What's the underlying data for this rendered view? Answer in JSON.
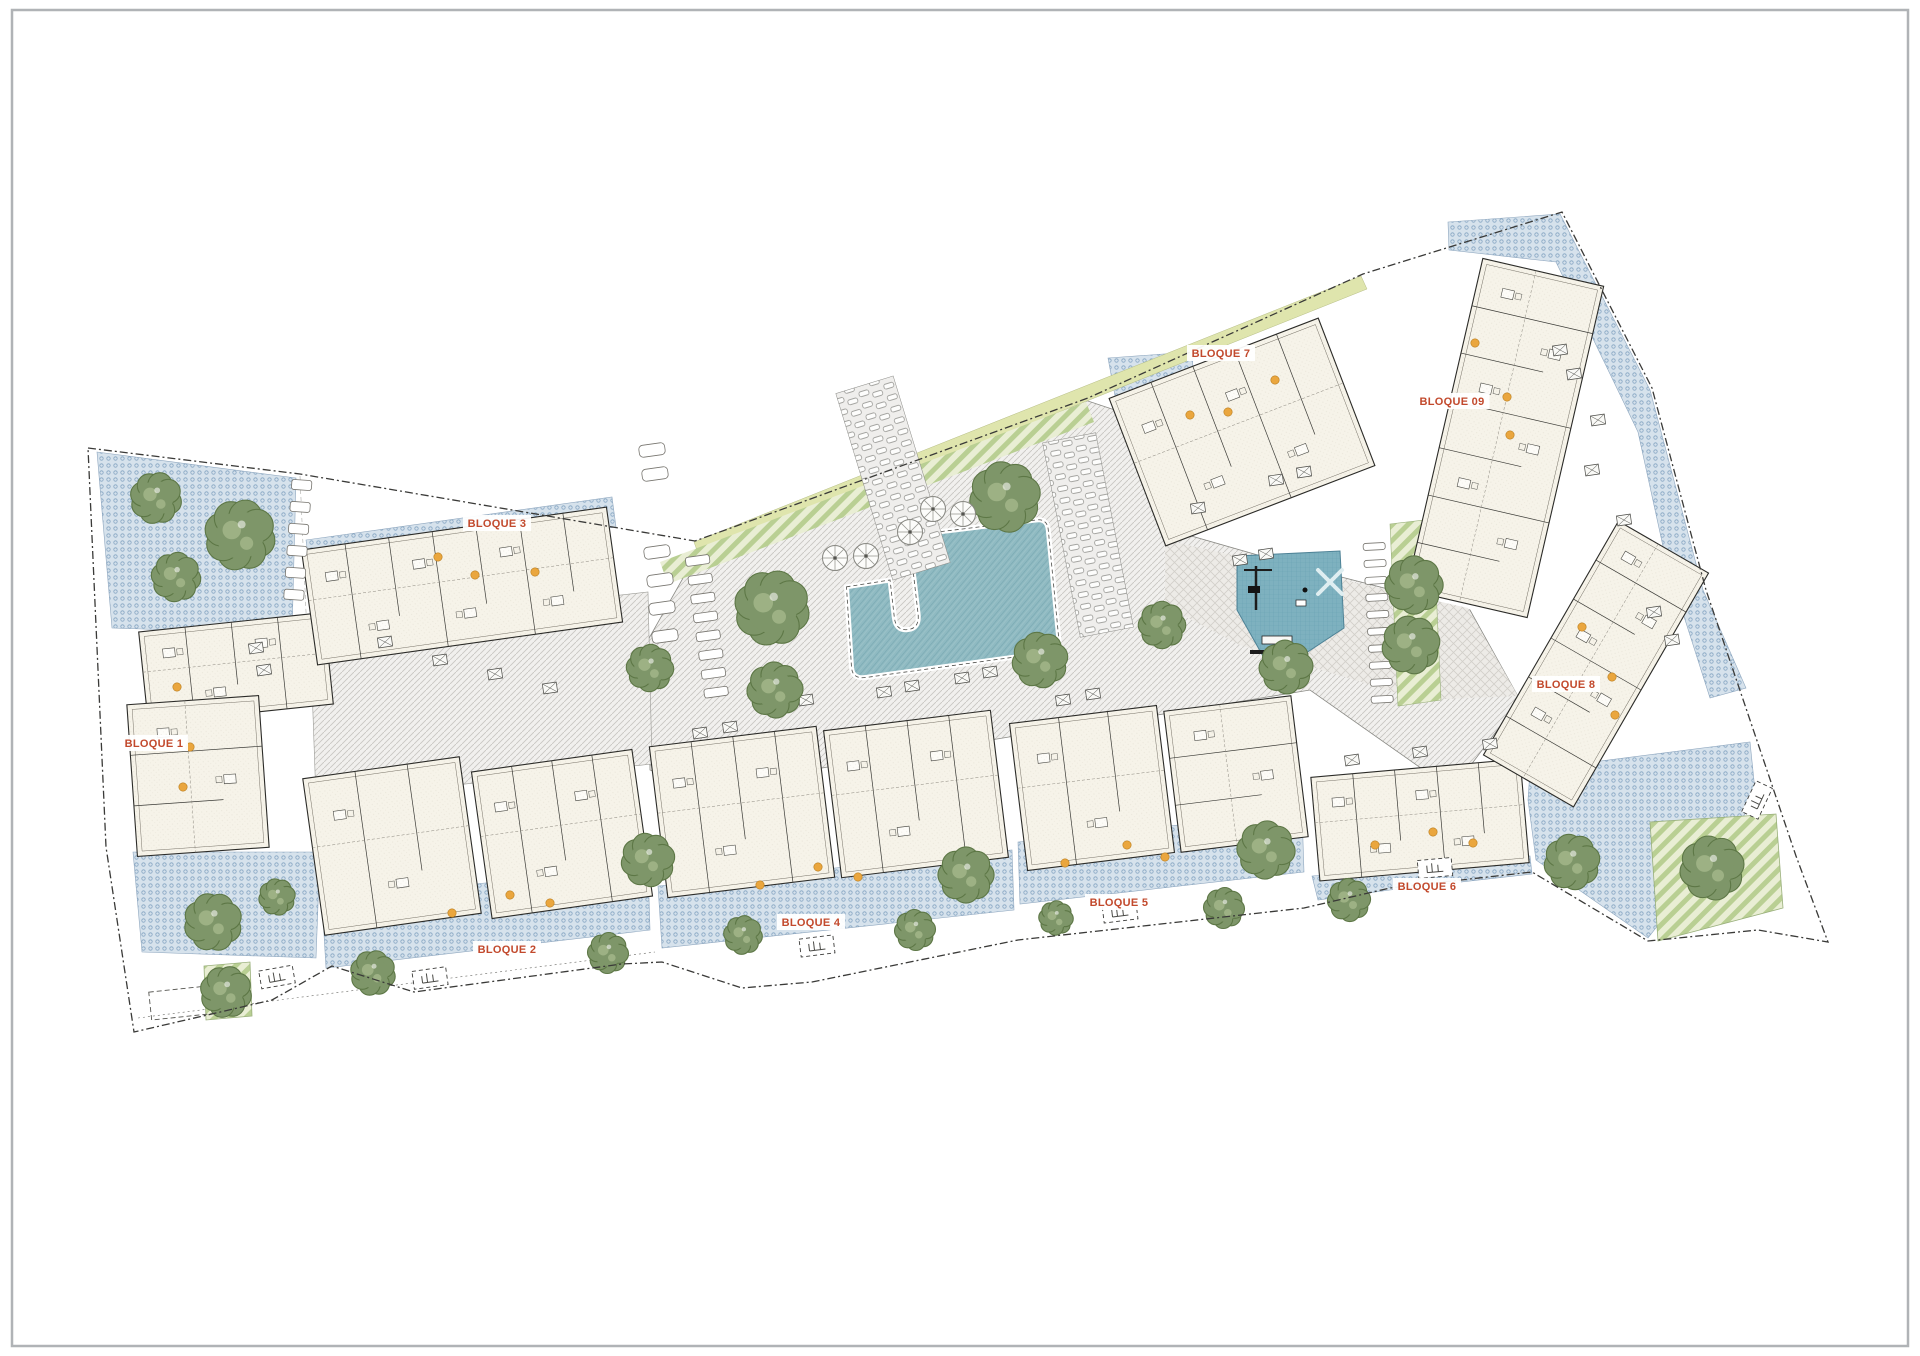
{
  "document": {
    "type": "architectural-site-plan",
    "frame_color": "#b0b3b6",
    "background": "#ffffff"
  },
  "colors": {
    "label": "#c2492c",
    "boundary": "#3a3a38",
    "paving": "#f1f0ee",
    "terrace_dots": "#d6e2ec",
    "pool": "#8fbac2",
    "playground": "#7eb1bf",
    "lawn": "#dfe5ad",
    "tree": "#7e9669",
    "tree_edge": "#5d7746",
    "tree_light": "#9db184",
    "building": "#f6f3e9",
    "building_line": "#2b2b28",
    "door": "#eaa63e"
  },
  "bloques": [
    {
      "id": "bloque-1",
      "label": "BLOQUE 1",
      "x": 154,
      "y": 747
    },
    {
      "id": "bloque-2",
      "label": "BLOQUE 2",
      "x": 507,
      "y": 953
    },
    {
      "id": "bloque-3",
      "label": "BLOQUE 3",
      "x": 497,
      "y": 527
    },
    {
      "id": "bloque-4",
      "label": "BLOQUE 4",
      "x": 811,
      "y": 926
    },
    {
      "id": "bloque-5",
      "label": "BLOQUE 5",
      "x": 1119,
      "y": 906
    },
    {
      "id": "bloque-6",
      "label": "BLOQUE 6",
      "x": 1427,
      "y": 890
    },
    {
      "id": "bloque-7",
      "label": "BLOQUE 7",
      "x": 1221,
      "y": 357
    },
    {
      "id": "bloque-8",
      "label": "BLOQUE 8",
      "x": 1566,
      "y": 688
    },
    {
      "id": "bloque-09",
      "label": "BLOQUE 09",
      "x": 1452,
      "y": 405
    }
  ],
  "scene": {
    "buildings": [
      {
        "b": "1a",
        "cx": 236,
        "cy": 668,
        "w": 186,
        "h": 92,
        "rot": -6
      },
      {
        "b": "1b",
        "cx": 198,
        "cy": 776,
        "w": 132,
        "h": 152,
        "rot": -4
      },
      {
        "b": "3",
        "cx": 462,
        "cy": 586,
        "w": 308,
        "h": 116,
        "rot": -8
      },
      {
        "b": "2a",
        "cx": 392,
        "cy": 846,
        "w": 158,
        "h": 158,
        "rot": -8
      },
      {
        "b": "2b",
        "cx": 562,
        "cy": 834,
        "w": 162,
        "h": 148,
        "rot": -8
      },
      {
        "b": "4a",
        "cx": 742,
        "cy": 812,
        "w": 168,
        "h": 152,
        "rot": -7
      },
      {
        "b": "4b",
        "cx": 916,
        "cy": 794,
        "w": 168,
        "h": 148,
        "rot": -7
      },
      {
        "b": "5a",
        "cx": 1092,
        "cy": 788,
        "w": 148,
        "h": 148,
        "rot": -7
      },
      {
        "b": "5b",
        "cx": 1236,
        "cy": 774,
        "w": 128,
        "h": 142,
        "rot": -7
      },
      {
        "b": "6",
        "cx": 1420,
        "cy": 820,
        "w": 210,
        "h": 104,
        "rot": -5
      },
      {
        "b": "7",
        "cx": 1242,
        "cy": 432,
        "w": 224,
        "h": 158,
        "rot": -21
      },
      {
        "b": "09",
        "cx": 1505,
        "cy": 438,
        "w": 124,
        "h": 340,
        "rot": 13
      },
      {
        "b": "8",
        "cx": 1596,
        "cy": 664,
        "w": 104,
        "h": 270,
        "rot": 30
      }
    ],
    "trees": [
      [
        156,
        498,
        24
      ],
      [
        240,
        535,
        33
      ],
      [
        176,
        577,
        23
      ],
      [
        213,
        922,
        27
      ],
      [
        277,
        897,
        17
      ],
      [
        226,
        992,
        24
      ],
      [
        373,
        973,
        21
      ],
      [
        608,
        953,
        19
      ],
      [
        650,
        668,
        22
      ],
      [
        772,
        608,
        35
      ],
      [
        1005,
        497,
        33
      ],
      [
        648,
        860,
        25
      ],
      [
        743,
        935,
        18
      ],
      [
        915,
        930,
        19
      ],
      [
        966,
        875,
        26
      ],
      [
        775,
        690,
        26
      ],
      [
        1040,
        660,
        26
      ],
      [
        1286,
        667,
        25
      ],
      [
        1266,
        850,
        27
      ],
      [
        1056,
        918,
        16
      ],
      [
        1224,
        908,
        19
      ],
      [
        1349,
        900,
        20
      ],
      [
        1162,
        625,
        22
      ],
      [
        1414,
        585,
        27
      ],
      [
        1411,
        645,
        27
      ],
      [
        1572,
        862,
        26
      ],
      [
        1712,
        868,
        30
      ]
    ],
    "parasols": [
      [
        835,
        558
      ],
      [
        866,
        556
      ],
      [
        910,
        532
      ],
      [
        933,
        509
      ],
      [
        963,
        514
      ]
    ],
    "doors": [
      [
        177,
        687
      ],
      [
        190,
        747
      ],
      [
        183,
        787
      ],
      [
        438,
        557
      ],
      [
        475,
        575
      ],
      [
        535,
        572
      ],
      [
        510,
        895
      ],
      [
        550,
        903
      ],
      [
        452,
        913
      ],
      [
        818,
        867
      ],
      [
        858,
        877
      ],
      [
        760,
        885
      ],
      [
        1065,
        863
      ],
      [
        1127,
        845
      ],
      [
        1165,
        857
      ],
      [
        1433,
        832
      ],
      [
        1473,
        843
      ],
      [
        1375,
        845
      ],
      [
        1582,
        627
      ],
      [
        1612,
        677
      ],
      [
        1615,
        715
      ],
      [
        1275,
        380
      ],
      [
        1190,
        415
      ],
      [
        1228,
        412
      ],
      [
        1475,
        343
      ],
      [
        1507,
        397
      ],
      [
        1510,
        435
      ]
    ],
    "furniture": [
      [
        778,
        706
      ],
      [
        806,
        700
      ],
      [
        884,
        692
      ],
      [
        912,
        686
      ],
      [
        962,
        678
      ],
      [
        990,
        672
      ],
      [
        1026,
        666
      ],
      [
        385,
        642
      ],
      [
        440,
        660
      ],
      [
        495,
        674
      ],
      [
        550,
        688
      ],
      [
        1198,
        508
      ],
      [
        1276,
        480
      ],
      [
        1304,
        472
      ],
      [
        1240,
        560
      ],
      [
        1266,
        554
      ],
      [
        1560,
        350
      ],
      [
        1574,
        374
      ],
      [
        1598,
        420
      ],
      [
        1592,
        470
      ],
      [
        1624,
        520
      ],
      [
        1654,
        612
      ],
      [
        1672,
        640
      ],
      [
        1352,
        760
      ],
      [
        1420,
        752
      ],
      [
        1490,
        744
      ],
      [
        1063,
        700
      ],
      [
        1093,
        694
      ],
      [
        700,
        733
      ],
      [
        730,
        727
      ],
      [
        256,
        648
      ],
      [
        264,
        670
      ]
    ],
    "gates": [
      {
        "x": 277,
        "y": 977,
        "rot": -10
      },
      {
        "x": 430,
        "y": 978,
        "rot": -8
      },
      {
        "x": 817,
        "y": 946,
        "rot": -7
      },
      {
        "x": 1120,
        "y": 912,
        "rot": -7
      },
      {
        "x": 1435,
        "y": 868,
        "rot": -5
      },
      {
        "x": 1757,
        "y": 800,
        "rot": -65
      }
    ],
    "stones": [
      {
        "x": 302,
        "y": 480,
        "step": 22,
        "count": 6,
        "w": 20,
        "h": 10,
        "rot": 4
      },
      {
        "x": 697,
        "y": 556,
        "step": 19,
        "count": 8,
        "w": 24,
        "h": 9,
        "rot": -8
      },
      {
        "x": 1374,
        "y": 543,
        "step": 17,
        "count": 10,
        "w": 22,
        "h": 7,
        "rot": -3
      }
    ],
    "planters": [
      [
        652,
        450
      ],
      [
        655,
        474
      ],
      [
        657,
        552
      ],
      [
        660,
        580
      ],
      [
        662,
        608
      ],
      [
        665,
        636
      ]
    ],
    "strips": [
      {
        "cx": 893,
        "cy": 478,
        "w": 60,
        "h": 195,
        "rot": -17
      },
      {
        "cx": 1088,
        "cy": 535,
        "w": 54,
        "h": 198,
        "rot": -11
      }
    ]
  }
}
